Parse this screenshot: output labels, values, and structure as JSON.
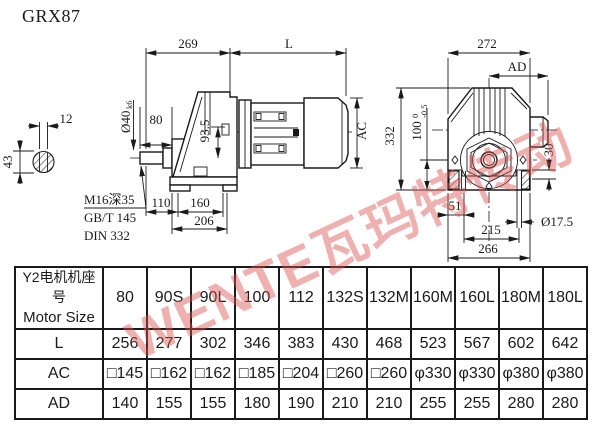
{
  "title": "GRX87",
  "watermark": {
    "text": "WENTE瓦玛特传动",
    "color": "#db5050"
  },
  "drawing": {
    "shaft_section": {
      "key_width": "12",
      "diameter": "43"
    },
    "shaft_end_note": {
      "thread": "M16深35",
      "std1": "GB/T 145",
      "std2": "DIN 332"
    },
    "side_view": {
      "gearbox_length": "269",
      "motor_length_label": "L",
      "shaft_dia": "Ø40",
      "shaft_dia_tol": "k6",
      "shaft_length": "80",
      "center_height": "93.5",
      "motor_height_label": "AC",
      "foot_front": "110",
      "foot_span": "160",
      "base_length": "206"
    },
    "end_view": {
      "overall_width": "272",
      "terminal_label": "AD",
      "overall_height": "332",
      "axis_height": "100",
      "axis_tol_upper": "0",
      "axis_tol_lower": "-0.5",
      "foot_height": "30",
      "hole_offset": "51",
      "hole_dia": "Ø17.5",
      "hole_span": "215",
      "base_width": "266"
    }
  },
  "table": {
    "header_cn": "Y2电机机座号",
    "header_en": "Motor Size",
    "columns": [
      "80",
      "90S",
      "90L",
      "100",
      "112",
      "132S",
      "132M",
      "160M",
      "160L",
      "180M",
      "180L"
    ],
    "rows": [
      {
        "label": "L",
        "values": [
          "256",
          "277",
          "302",
          "346",
          "383",
          "430",
          "468",
          "523",
          "567",
          "602",
          "642"
        ]
      },
      {
        "label": "AC",
        "values": [
          "□145",
          "□162",
          "□162",
          "□185",
          "□204",
          "□260",
          "□260",
          "φ330",
          "φ330",
          "φ380",
          "φ380"
        ]
      },
      {
        "label": "AD",
        "values": [
          "140",
          "155",
          "155",
          "180",
          "190",
          "210",
          "210",
          "255",
          "255",
          "280",
          "280"
        ]
      }
    ]
  }
}
